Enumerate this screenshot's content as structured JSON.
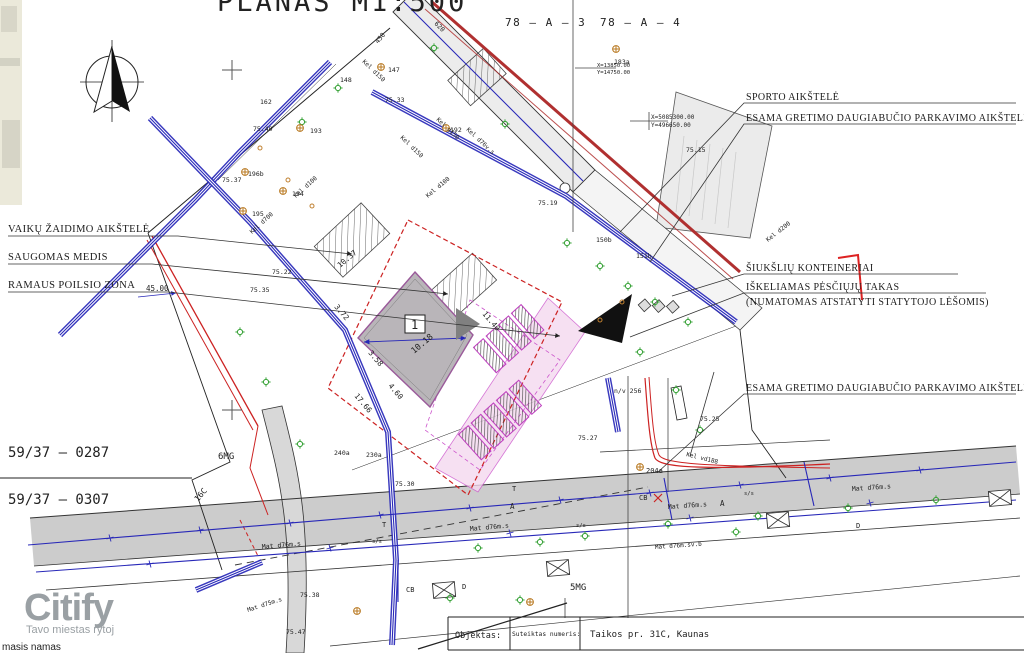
{
  "page": {
    "title": "PLANAS M1:500"
  },
  "grid": {
    "ref_left": "78 – A – 3",
    "ref_right": "78 – A – 4",
    "cross1": {
      "x": "X=13850.00",
      "y": "Y=14750.00"
    },
    "cross2": {
      "x": "X=5085300.00",
      "y": "Y=496650.00"
    }
  },
  "callouts": {
    "left": [
      "VAIKŲ ŽAIDIMO AIKŠTELĖ",
      "SAUGOMAS MEDIS",
      "RAMAUS POILSIO ZONA"
    ],
    "right": [
      "SPORTO AIKŠTELĖ",
      "ESAMA GRETIMO DAUGIABUČIO PARKAVIMO AIKŠTELĖ",
      "ŠIUKŠLIŲ KONTEINERIAI",
      "IŠKELIAMAS PĖSČIŲJŲ TAKAS",
      "ESAMA GRETIMO DAUGIABUČIO PARKAVIMO AIKŠTELĖ"
    ],
    "right_sub": "(NUMATOMAS ATSTATYTI STATYTOJO LĖŠOMIS)"
  },
  "parcels": {
    "p1": "59/37 – 0287",
    "p2": "59/37 – 0307",
    "mg6": "6MG",
    "mg5": "5MG",
    "c16": "16C"
  },
  "plan": {
    "building_no": "1",
    "dims": [
      "10.18",
      "10.37",
      "3.72",
      "3.58",
      "4.60",
      "17.66",
      "11.40",
      "45.00"
    ],
    "elev": [
      "75.33",
      "75.40",
      "75.37",
      "75.35",
      "75.22",
      "75.25",
      "75.30",
      "75.27",
      "75.38",
      "75.47",
      "75.15",
      "75.19"
    ],
    "pipes": [
      "Kel d100",
      "Kel d150",
      "Kel d700",
      "Kel d76v.s",
      "Kel d100",
      "Kel d150",
      "Kel d150",
      "Mat d76m.s",
      "Mat d76m.s",
      "Mat d76m.s",
      "Mat d76m.s",
      "Mat d76m.sv.b",
      "Mat d75m.s",
      "Kel d200"
    ],
    "nodes": [
      "147",
      "148",
      "183a",
      "192",
      "193",
      "194",
      "195",
      "196b",
      "150b",
      "151b",
      "204a",
      "240a",
      "230a",
      "n/v 256",
      "450",
      "620",
      "162"
    ],
    "marks": [
      "A",
      "A",
      "D",
      "D",
      "CB",
      "CB",
      "T",
      "T",
      "s/s",
      "s/s",
      "s/s"
    ],
    "red_label": "Kel vd188"
  },
  "logo": {
    "name": "Citify",
    "tagline": "Tavo miestas rytoj"
  },
  "caption": "masis namas",
  "titleblock": {
    "objektas": "Objektas:",
    "numeris": "Suteiktas numeris:",
    "address": "Taikos pr. 31C, Kaunas"
  },
  "colors": {
    "utility_blue": "#2828b8",
    "boundary_red": "#cc2222",
    "path_magenta": "#cc55cc",
    "tree_green": "#33a033",
    "elevation_green": "#55bb55",
    "manhole_orange": "#b87820",
    "logo_gray": "#9aa0a4",
    "numeris_red": "#cc3333",
    "building_gray": "#b9b5b9"
  }
}
